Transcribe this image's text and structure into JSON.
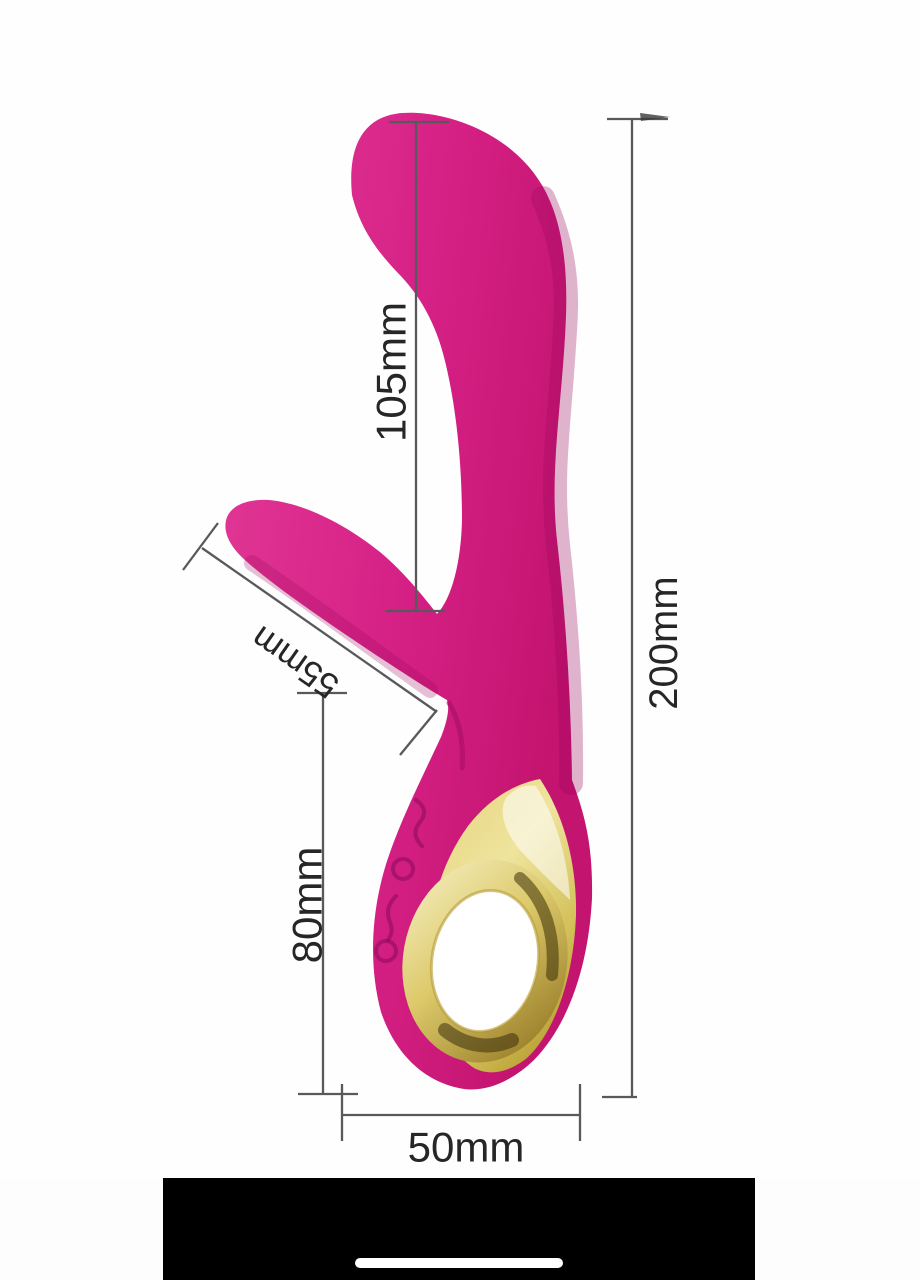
{
  "page": {
    "background": "#fdfdfd",
    "type": "product-dimension-diagram"
  },
  "product_diagram": {
    "device": {
      "name": "rabbit-style-massager",
      "body_color": "#d92a8a",
      "body_color_dark": "#b6136c",
      "gold_color": "#d9c567",
      "gold_color_light": "#f6efc3",
      "gold_color_dark": "#8a6d1a",
      "ring_hole_color": "#ffffff"
    },
    "dimension_style": {
      "line_color": "#58595b",
      "text_color": "#262626"
    },
    "measurements": {
      "shaft_length": {
        "label": "105mm"
      },
      "total_length": {
        "label": "200mm"
      },
      "arm_length": {
        "label": "55mm"
      },
      "handle_length": {
        "label": "80mm"
      },
      "base_width": {
        "label": "50mm"
      }
    }
  },
  "system_ui": {
    "bottom_bar_color": "#000000",
    "home_indicator_color": "#ffffff"
  }
}
